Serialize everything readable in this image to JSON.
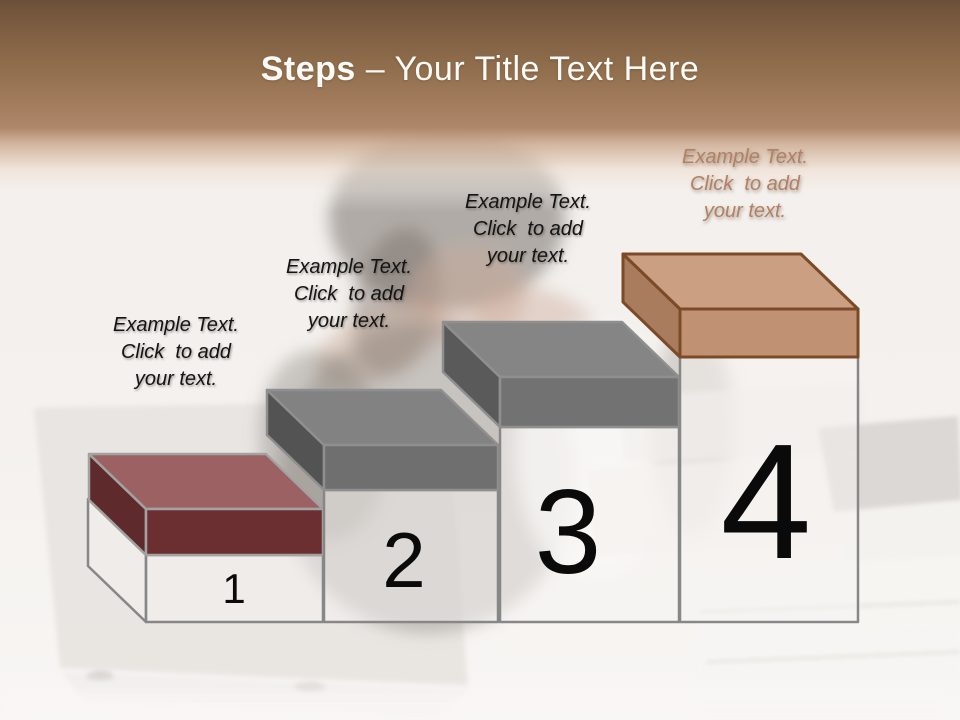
{
  "slide": {
    "title": {
      "emphasis": "Steps",
      "rest": " – Your Title Text Here"
    },
    "steps": [
      {
        "number": "1",
        "label": "Example Text.\nClick  to add\nyour text."
      },
      {
        "number": "2",
        "label": "Example Text.\nClick  to add\nyour text."
      },
      {
        "number": "3",
        "label": "Example Text.\nClick  to add\nyour text."
      },
      {
        "number": "4",
        "label": "Example Text.\nClick  to add\nyour text."
      }
    ]
  },
  "colors": {
    "header_top": "#6b5038",
    "header_mid": "#a87f62",
    "header_fade": "#f6f2ee",
    "title_text": "#fdfbf8",
    "label_text": "#141414",
    "label4_text": "#b08165",
    "number": "#0a0a0a",
    "pedestal_fill": "rgba(246,244,241,0.5)",
    "pedestal_stroke": "#878787",
    "slabs": [
      {
        "top": "#9c6163",
        "front": "#6b2f31",
        "side": "#5e2a2c",
        "stroke": "#a3a2a2"
      },
      {
        "top": "#828282",
        "front": "#6f6f6f",
        "side": "#535353",
        "stroke": "#8f8f8f"
      },
      {
        "top": "#858585",
        "front": "#727272",
        "side": "#5a5a5a",
        "stroke": "#8f8f8f"
      },
      {
        "top": "#cb9f82",
        "front": "#c09273",
        "side": "#a87c5d",
        "stroke": "#7c4a27"
      }
    ]
  }
}
